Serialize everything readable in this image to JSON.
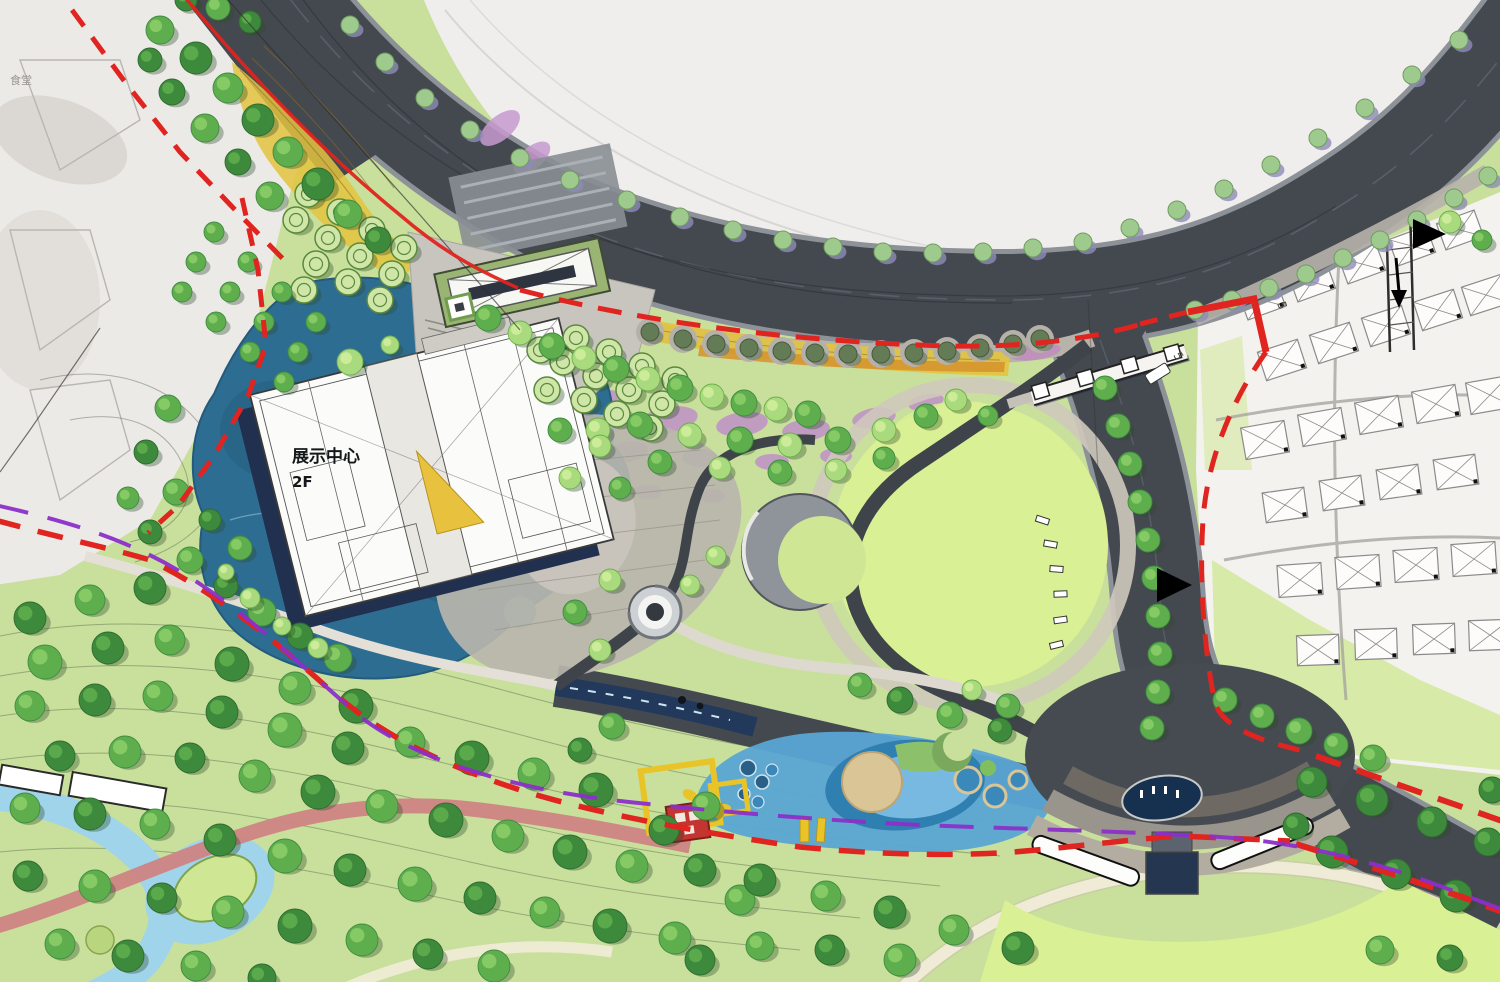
{
  "plan": {
    "building_label": {
      "name": "展示中心",
      "floors": "2F"
    },
    "context_label": "食堂",
    "dimension_labels": [
      "5",
      "5"
    ]
  },
  "palette": {
    "ring_road": "#44494f",
    "road_casing": "#8d9198",
    "paper": "#efeeec",
    "cad_paper": "#f3f2ee",
    "cad_line": "#8a8a8a",
    "park_base": "#c8e09c",
    "lawn_bright": "#d9f094",
    "water_deep": "#2e6d92",
    "water_light": "#9fd4ea",
    "play_blue": "#5aa5d4",
    "sand": "#d9c596",
    "tree_dark": "#3e8a3c",
    "tree_mid": "#5fae4e",
    "tree_light": "#a9db7e",
    "street_tree": "#9fca8d",
    "olive_tree": "#647c56",
    "boundary_red": "#e02420",
    "utility_purple": "#8b2fc9",
    "flower_purple": "#bd8cc9",
    "meadow_yellow": "#e3c33e",
    "meadow_orange": "#d6952f",
    "track_pink": "#cf8484",
    "pavement": "#c8c5bf",
    "building_shadow": "#22304f",
    "accent_triangle": "#e8c23e",
    "canopy_green": "#9ab573"
  }
}
